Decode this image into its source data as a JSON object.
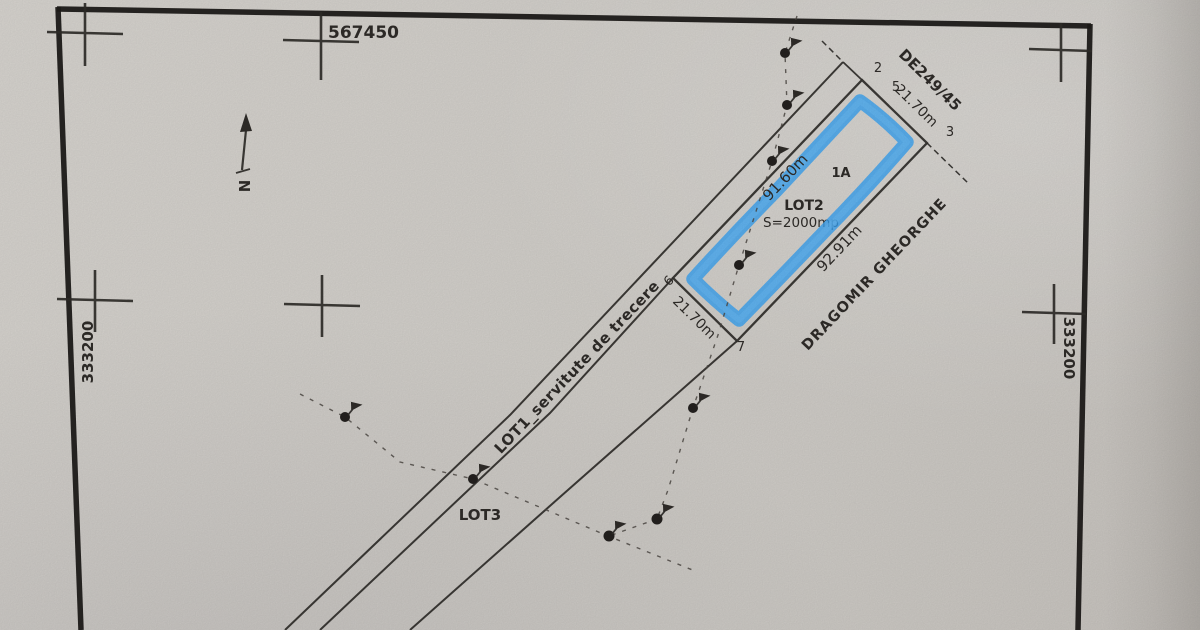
{
  "grid": {
    "top_coord": "567450",
    "left_coord": "333200",
    "right_coord": "333200"
  },
  "north": {
    "label": "N"
  },
  "road": {
    "label": "DE249/45"
  },
  "neighbor": {
    "name": "DRAGOMIR GHEORGHE"
  },
  "lot1": {
    "label": "LOT1_servitute de trecere"
  },
  "lot2": {
    "name": "LOT2",
    "area": "S=2000mp",
    "corner_tag": "1A",
    "len_left": "91.60m",
    "len_right": "92.91m",
    "width_top": "21.70m",
    "width_bottom": "21.70m"
  },
  "lot3": {
    "name": "LOT3"
  },
  "vertices": {
    "v2": "2",
    "v3": "3",
    "v5": "5",
    "v6": "6",
    "v7": "7"
  },
  "colors": {
    "paper": "#d3d0cb",
    "ink": "#2f2c29",
    "highlight": "#38a3f2"
  }
}
